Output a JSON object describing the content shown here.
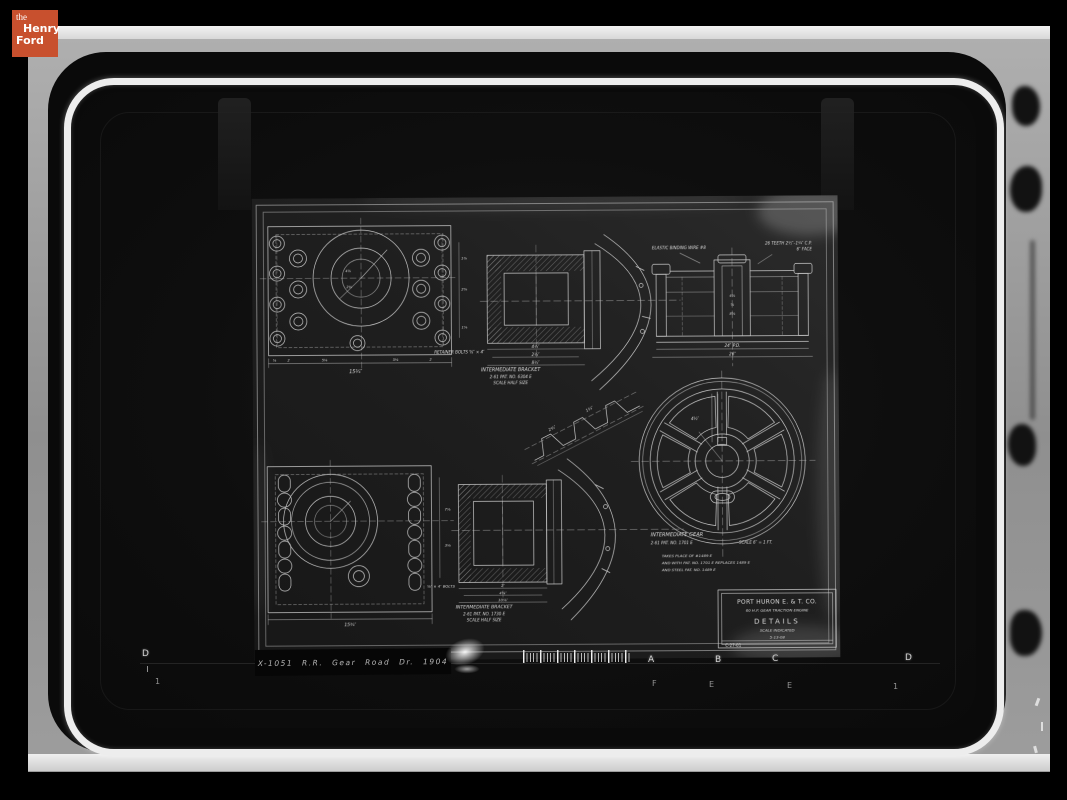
{
  "branding": {
    "logo_color": "#c8502e",
    "line1": "the",
    "line2": "Henry",
    "line3": "Ford"
  },
  "photo": {
    "caption": "X-1051 R.R. Gear Road Dr. 1904",
    "ruler": {
      "top_letters": [
        {
          "label": "D"
        },
        {
          "label": "A"
        },
        {
          "label": "B"
        },
        {
          "label": "C"
        },
        {
          "label": "D"
        }
      ],
      "bottom_marks": [
        {
          "label": "1"
        },
        {
          "label": "F"
        },
        {
          "label": "E"
        },
        {
          "label": "E"
        },
        {
          "label": "1"
        }
      ]
    }
  },
  "drawing": {
    "title_block": {
      "company": "PORT HURON E. & T. CO.",
      "subtitle": "60 H.P. GEAR TRACTION ENGINE",
      "title": "DETAILS",
      "scale": "SCALE INDICATED",
      "date": "5-13-08",
      "number": "C-27-01"
    },
    "labels": {
      "bracket_top": {
        "title": "INTERMEDIATE BRACKET",
        "ref": "2-61 PAT. NO. 6304 E",
        "scale": "SCALE HALF SIZE"
      },
      "bracket_bottom": {
        "title": "INTERMEDIATE BRACKET",
        "ref": "2-61 PAT. NO. 1730 E",
        "scale": "SCALE HALF SIZE"
      },
      "gear": {
        "title": "INTERMEDIATE GEAR",
        "ref": "2-61 PAT. NO. 1701 E",
        "scale": "SCALE 6″ = 1 FT.",
        "note1": "TAKES PLACE OF #1489 E",
        "note2": "AND WITH PAT. NO. 1701 E REPLACES 1489 E",
        "note3": "AND STEEL PAT. NO. 1489 E"
      },
      "section": {
        "left": "ELASTIC BINDING WIRE #8",
        "right1": "26 TEETH 2½″–1¼″ C.P.",
        "right2": "6″ FACE"
      },
      "retainer_note": "RETAINER BOLTS ⅝″ × 4″",
      "bolts_note": "⅝″ × 4″ BOLTS"
    },
    "dims": {
      "d01": "⅝",
      "d02": "2",
      "d03": "5⅛",
      "d04": "5⅛",
      "d05": "2",
      "d06": "15¾″",
      "d07": "1⅞",
      "d08": "2⅝",
      "d09": "1⅞",
      "d10": "4½″",
      "d11": "2½″",
      "d12": "8½″",
      "d13": "24″ P.D.",
      "d14": "26″",
      "d15": "4⅞",
      "d16": "⅝",
      "d17": "8⅝",
      "d18": "2½″",
      "d19": "1¼″",
      "d20": "4½″",
      "d21": "15¾″",
      "d22": "7⅞",
      "d23": "3⅛",
      "d24": "2″",
      "d25": "4⅝″",
      "d26": "10⅞″",
      "d27": "4⅞",
      "d28": "2⅛"
    }
  }
}
